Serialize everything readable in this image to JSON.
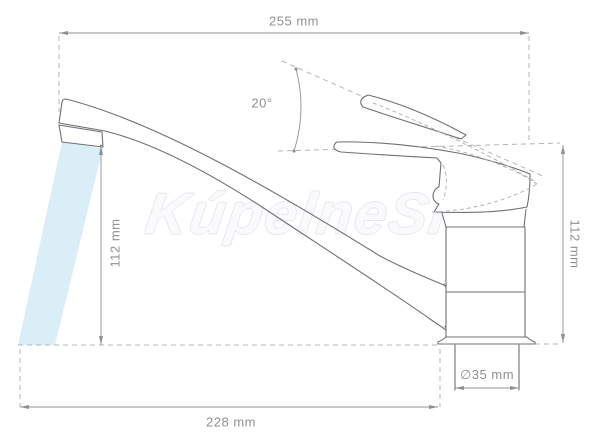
{
  "diagram": {
    "type": "technical-drawing",
    "subject": "single-lever kitchen sink faucet, side view with dimensions",
    "dimensions": {
      "top_width": "255 mm",
      "handle_angle": "20°",
      "spout_height_left": "112 mm",
      "body_height_right": "112 mm",
      "bottom_reach": "228 mm",
      "base_diameter": "∅35 mm"
    },
    "watermark": "KúpelneSK",
    "colors": {
      "line": "#6f7074",
      "dashed": "#b3b4b8",
      "dimension": "#8f9094",
      "water": "#d9eef7",
      "watermark_outline": "#e7e7ed",
      "watermark_fill": "#fafafc"
    }
  }
}
